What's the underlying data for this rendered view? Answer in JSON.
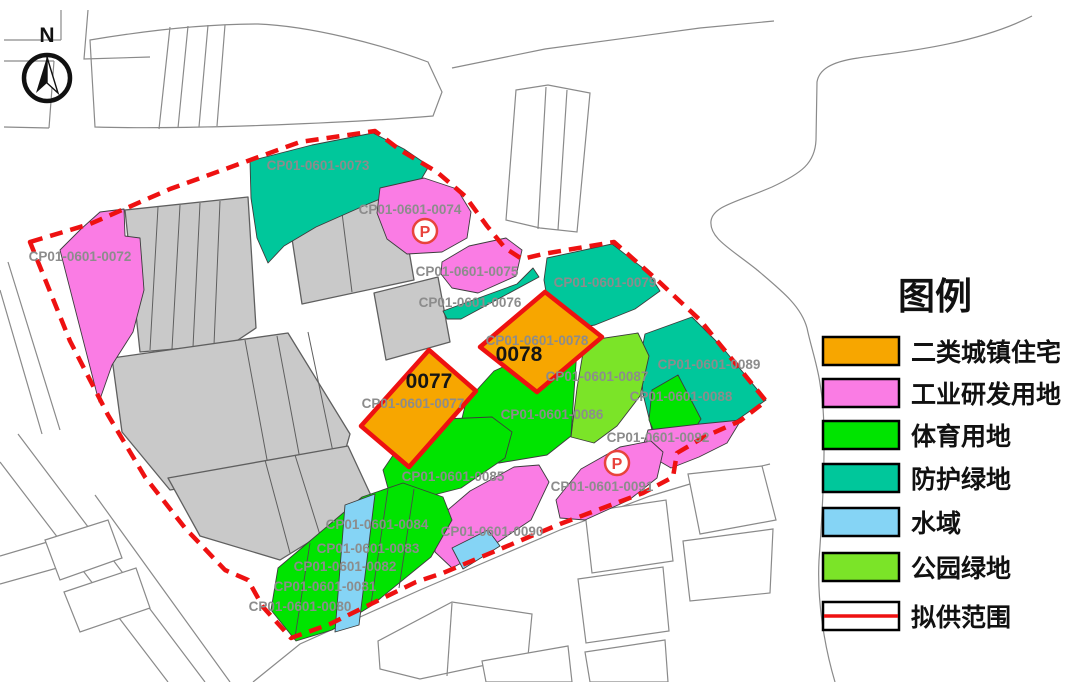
{
  "map": {
    "north_label": "N",
    "parking_label": "P",
    "parcels": [
      {
        "code": "CP01-0601-0072",
        "land_use": "工业研发用地"
      },
      {
        "code": "CP01-0601-0073",
        "land_use": "防护绿地"
      },
      {
        "code": "CP01-0601-0074",
        "land_use": "工业研发用地"
      },
      {
        "code": "CP01-0601-0075",
        "land_use": "工业研发用地"
      },
      {
        "code": "CP01-0601-0076",
        "land_use": "防护绿地"
      },
      {
        "code": "CP01-0601-0077",
        "land_use": "二类城镇住宅"
      },
      {
        "code": "CP01-0601-0078",
        "land_use": "二类城镇住宅"
      },
      {
        "code": "CP01-0601-0079",
        "land_use": "防护绿地"
      },
      {
        "code": "CP01-0601-0080",
        "land_use": "体育用地"
      },
      {
        "code": "CP01-0601-0081",
        "land_use": "体育用地"
      },
      {
        "code": "CP01-0601-0082",
        "land_use": "体育用地"
      },
      {
        "code": "CP01-0601-0083",
        "land_use": "体育用地"
      },
      {
        "code": "CP01-0601-0084",
        "land_use": "体育用地"
      },
      {
        "code": "CP01-0601-0085",
        "land_use": "体育用地"
      },
      {
        "code": "CP01-0601-0086",
        "land_use": "体育用地"
      },
      {
        "code": "CP01-0601-0087",
        "land_use": "公园绿地"
      },
      {
        "code": "CP01-0601-0088",
        "land_use": "体育用地"
      },
      {
        "code": "CP01-0601-0089",
        "land_use": "防护绿地"
      },
      {
        "code": "CP01-0601-0090",
        "land_use": "工业研发用地"
      },
      {
        "code": "CP01-0601-0091",
        "land_use": "工业研发用地"
      },
      {
        "code": "CP01-0601-0092",
        "land_use": "工业研发用地"
      }
    ],
    "highlights": [
      {
        "id": "0077"
      },
      {
        "id": "0078"
      }
    ]
  },
  "legend": {
    "title": "图例",
    "items": [
      {
        "label": "二类城镇住宅",
        "color": "#F7A600"
      },
      {
        "label": "工业研发用地",
        "color": "#FA7CE4"
      },
      {
        "label": "体育用地",
        "color": "#00E400"
      },
      {
        "label": "防护绿地",
        "color": "#00C79B"
      },
      {
        "label": "水域",
        "color": "#85D4F5"
      },
      {
        "label": "公园绿地",
        "color": "#7BE428"
      },
      {
        "label": "拟供范围",
        "color": "#EE1111"
      }
    ]
  },
  "colors": {
    "residential": "#F7A600",
    "industrial": "#FA7CE4",
    "sports": "#00E400",
    "protective": "#00C79B",
    "water": "#85D4F5",
    "park": "#7BE428",
    "boundary_red": "#EE1111",
    "existing_gray": "#C9C9C9"
  }
}
